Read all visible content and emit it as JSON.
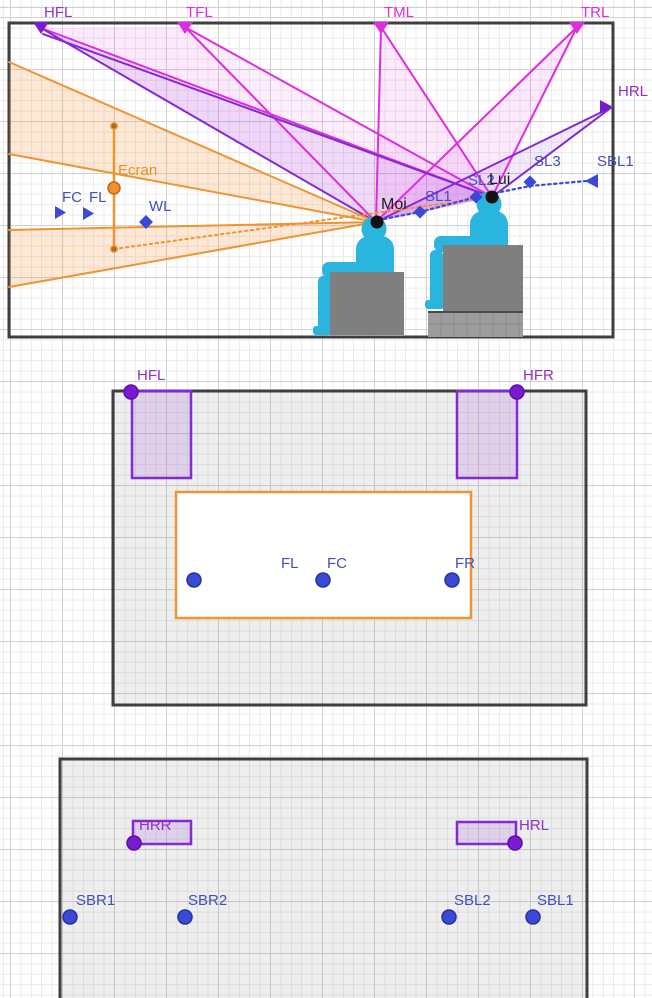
{
  "side_view": {
    "hfl": "HFL",
    "tfl": "TFL",
    "tml": "TML",
    "trl": "TRL",
    "hrl": "HRL",
    "sl1": "SL1",
    "sl2": "SL2",
    "sl3": "SL3",
    "sbl1": "SBL1",
    "moi": "Moi",
    "lui": "Lui",
    "ecran": "Ecran",
    "fc": "FC",
    "fl": "FL",
    "wl": "WL"
  },
  "front_top_view": {
    "hfl": "HFL",
    "hfr": "HFR",
    "fl": "FL",
    "fc": "FC",
    "fr": "FR"
  },
  "rear_top_view": {
    "hrr": "HRR",
    "hrl": "HRL",
    "sbr1": "SBR1",
    "sbr2": "SBR2",
    "sbl2": "SBL2",
    "sbl1": "SBL1"
  },
  "colors": {
    "magenta": "#e02ce0",
    "purple": "#8429d3",
    "orange": "#ef9433",
    "blue": "#3a49d6",
    "room_border": "#3f3f3f",
    "person": "#29b5dd",
    "seat": "#7f7f7f"
  }
}
